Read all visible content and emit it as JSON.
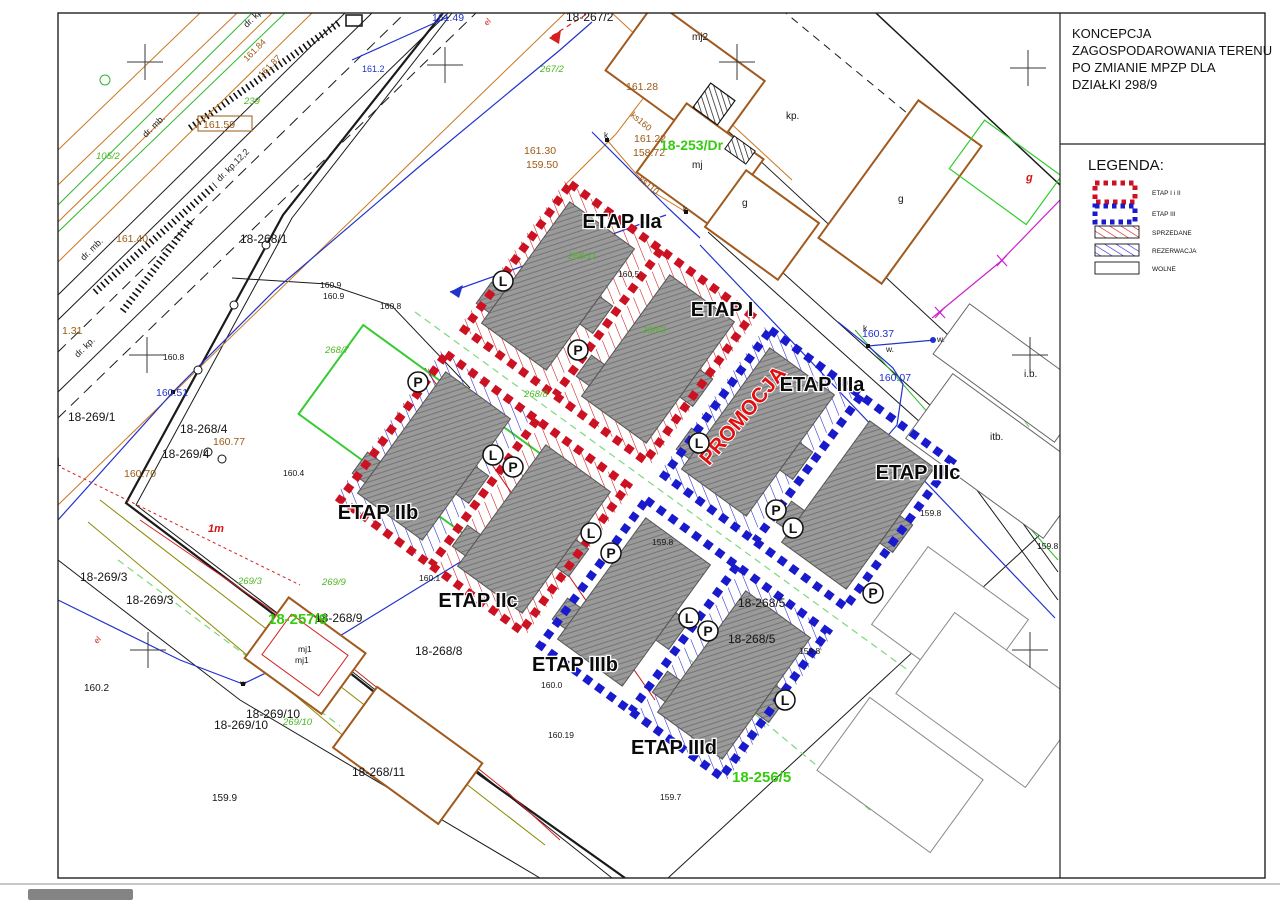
{
  "panel": {
    "title_lines": [
      "KONCEPCJA",
      "ZAGOSPODAROWANIA TERENU",
      "PO ZMIANIE MPZP DLA",
      "DZIAŁKI 298/9"
    ],
    "legend_title": "LEGENDA:",
    "legend_items": {
      "etap12": "ETAP I i II",
      "etap3": "ETAP III",
      "sold": "SPRZEDANE",
      "reserved": "REZERWACJA",
      "free": "WOLNE"
    }
  },
  "colors": {
    "stage12_border": "#cc1122",
    "stage3_border": "#1a1acd",
    "sold_hatch": "#cc1111",
    "reserved_hatch": "#2222cc",
    "existing_building": "#a05a1e",
    "green_parcel": "#4cb820"
  },
  "stages": {
    "iia": "ETAP IIa",
    "i": "ETAP I",
    "iiia": "ETAP IIIa",
    "iiic": "ETAP IIIc",
    "iib": "ETAP IIb",
    "iic": "ETAP IIc",
    "iiib": "ETAP IIIb",
    "iiid": "ETAP IIId",
    "promo": "PROMOCJA"
  },
  "lp": [
    "L",
    "P",
    "L",
    "P",
    "P",
    "L",
    "P",
    "L",
    "P",
    "L",
    "P",
    "L",
    "L",
    "P"
  ],
  "parcels": {
    "p18_267_2": "18-267/2",
    "p18_268_1": "18-268/1",
    "p18_269_1a": "18-269/1",
    "p18_269_1b": "18-269/1",
    "p18_268_4": "18-268/4",
    "p18_269_4": "18-269/4",
    "p18_269_3a": "18-269/3",
    "p18_269_3b": "18-269/3",
    "p18_268_9": "18-268/9",
    "p18_268_8": "18-268/8",
    "p18_269_10a": "18-269/10",
    "p18_269_10b": "18-269/10",
    "p18_268_11": "18-268/11",
    "p18_268_5a": "18-268/5",
    "p18_268_5b": "18-268/5",
    "mj2": "mj2",
    "mj": "mj",
    "mj1a": "mj1",
    "mj1b": "mj1",
    "g1": "g",
    "g2": "g",
    "g3": "g",
    "kp": "kp.",
    "ib": "i.b.",
    "itb": "itb.",
    "w1": "w.",
    "w2": "w.",
    "w3": "w",
    "k1": "k",
    "k2": "k",
    "k3": "k",
    "onem": "1m"
  },
  "green": {
    "g267_2": "267/2",
    "g105_2": "105/2",
    "g239": "239",
    "g268_7": "268/7",
    "g268_8": "268/8",
    "g269_9": "269/9",
    "g269_3": "269/3",
    "g269_10": "269/10",
    "g268_11": "268/11",
    "g268_3": "268/3",
    "big253": "18-253/Dr",
    "big257": "18-257/9",
    "big256": "18-256/5"
  },
  "elev": {
    "e16149": "161.49",
    "e16128": "161.28",
    "e16122": "161.22",
    "e15872": "158.72",
    "e16130": "161.30",
    "e15950": "159.50",
    "e16159": "161.59",
    "e16140": "161.40",
    "e131": "1.31",
    "e16051": "160.51",
    "e16077": "160.77",
    "e16070": "160.70",
    "e1609a": "160.9",
    "e1609b": "160.9",
    "e1608a": "160.8",
    "e1608b": "160.8",
    "e1605": "160.5",
    "e16037": "160.37",
    "e16007": "160.07",
    "e1598a": "159.8",
    "e1598b": "159.8",
    "e1598c": "159.8",
    "e1598d": "159.8",
    "e1601": "160.1",
    "e1600": "160.0",
    "e16019": "160.19",
    "e1602": "160.2",
    "e1599": "159.9",
    "e1597": "159.7",
    "e1612": "161.2",
    "e1604": "160.4",
    "e16184": "161.84",
    "e16187": "161.87"
  },
  "roads": {
    "dr_kp_a": "dr. kp.",
    "dr_kp_b": "dr. kp.",
    "dr_kp12": "dr. kp.12,2",
    "dr_mb_a": "dr. mb.",
    "dr_mb_b": "dr. mb."
  },
  "utils": {
    "ks160": "ks160",
    "ks110": "ks110",
    "el_a": "el",
    "el_b": "el"
  }
}
